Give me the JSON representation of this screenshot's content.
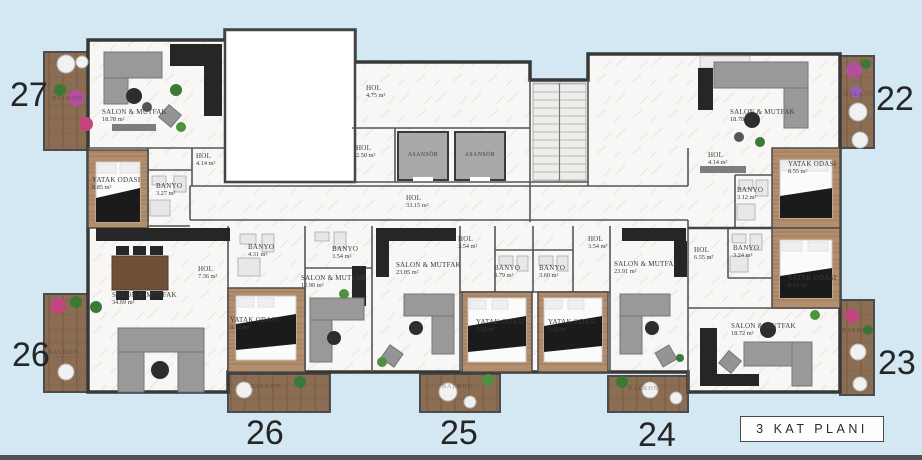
{
  "title": {
    "floor_label": "3  KAT PLANI"
  },
  "units": [
    "27",
    "26",
    "22",
    "23",
    "26",
    "25",
    "24"
  ],
  "rooms": [
    {
      "name": "SALON & MUTFAK",
      "area": "18.78 m²"
    },
    {
      "name": "YATAK ODASI",
      "area": "8.85 m²"
    },
    {
      "name": "BANYO",
      "area": "3.27 m²"
    },
    {
      "name": "HOL",
      "area": "4.14 m²"
    },
    {
      "name": "BALKON",
      "area": ""
    },
    {
      "name": "HOL",
      "area": "4.75 m²"
    },
    {
      "name": "HOL",
      "area": "2.50 m²"
    },
    {
      "name": "ASANSÖR",
      "area": ""
    },
    {
      "name": "ASANSÖR",
      "area": ""
    },
    {
      "name": "HOL",
      "area": "33.15 m²"
    },
    {
      "name": "SALON & MUTFAK",
      "area": "18.78 m²"
    },
    {
      "name": "HOL",
      "area": "4.14 m²"
    },
    {
      "name": "BANYO",
      "area": "3.12 m²"
    },
    {
      "name": "YATAK ODASI",
      "area": "8.55 m²"
    },
    {
      "name": "BALKON",
      "area": ""
    },
    {
      "name": "HOL",
      "area": "6.55 m²"
    },
    {
      "name": "BANYO",
      "area": "3.24 m²"
    },
    {
      "name": "YATAK ODASI",
      "area": "8.83 m²"
    },
    {
      "name": "SALON & MUTFAK",
      "area": "18.72 m²"
    },
    {
      "name": "BALKON",
      "area": ""
    },
    {
      "name": "SALON & MUTFAK",
      "area": "34.69 m²"
    },
    {
      "name": "HOL",
      "area": "7.36 m²"
    },
    {
      "name": "BANYO",
      "area": "4.31 m²"
    },
    {
      "name": "YATAK ODASI",
      "area": "8.92 m²"
    },
    {
      "name": "BALKON",
      "area": ""
    },
    {
      "name": "BALKON",
      "area": ""
    },
    {
      "name": "SALON & MUTFAK",
      "area": "12.90 m²"
    },
    {
      "name": "BANYO",
      "area": "3.54 m²"
    },
    {
      "name": "SALON & MUTFAK",
      "area": "23.85 m²"
    },
    {
      "name": "HOL",
      "area": "3.54 m²"
    },
    {
      "name": "BANYO",
      "area": "3.79 m²"
    },
    {
      "name": "BANYO",
      "area": "3.60 m²"
    },
    {
      "name": "YATAK ODASI",
      "area": "9.25 m²"
    },
    {
      "name": "YATAK ODASI",
      "area": "9.25 m²"
    },
    {
      "name": "HOL",
      "area": "3.54 m²"
    },
    {
      "name": "SALON & MUTFAK",
      "area": "23.91 m²"
    },
    {
      "name": "BALKON",
      "area": ""
    },
    {
      "name": "BALKON",
      "area": ""
    }
  ],
  "colors": {
    "background": "#d3e8f2",
    "wall": "#383838",
    "floor": "#f8f7f5",
    "wood": "#b28e6d",
    "deck": "#8a6d52",
    "kitchen": "#262626",
    "elevator": "#a9a9a9",
    "flower_pink": "#c2457f",
    "flower_magenta": "#b44f9e",
    "plant_green": "#3a7a36"
  }
}
